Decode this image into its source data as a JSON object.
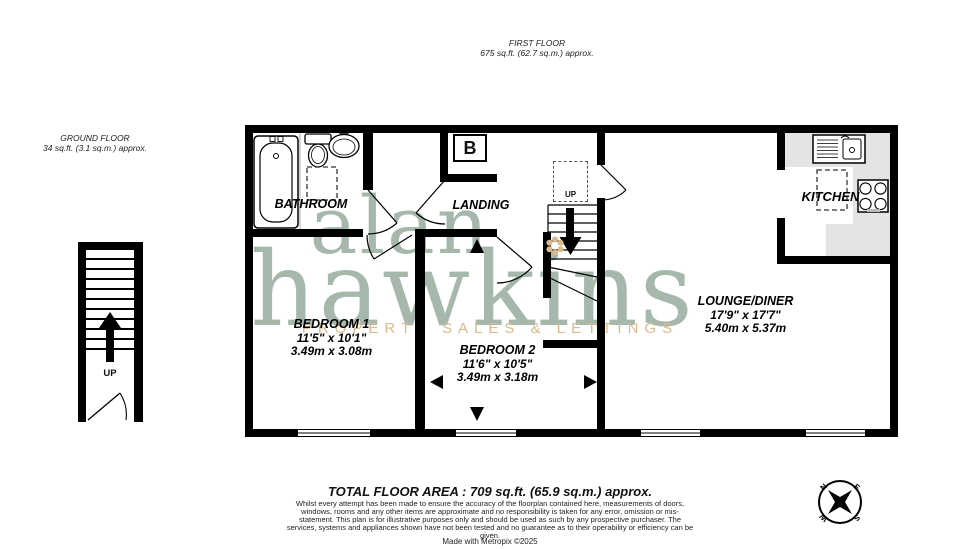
{
  "header": {
    "floor_title": "FIRST FLOOR",
    "floor_area": "675 sq.ft. (62.7 sq.m.) approx."
  },
  "ground_floor": {
    "title": "GROUND FLOOR",
    "area": "34 sq.ft. (3.1 sq.m.) approx.",
    "stairs_label": "UP"
  },
  "watermark": {
    "line1": "alan",
    "line2": "hawkins",
    "tagline": "PROPERTY SALES & LETTINGS",
    "colors": {
      "text": "#a6b7ac",
      "accent": "#d9ba8c"
    }
  },
  "rooms": {
    "bathroom": {
      "name": "BATHROOM"
    },
    "landing": {
      "name": "LANDING",
      "loft_label": "UP",
      "boiler_label": "B"
    },
    "kitchen": {
      "name": "KITCHEN"
    },
    "bedroom1": {
      "name": "BEDROOM 1",
      "imperial": "11'5\" x 10'1\"",
      "metric": "3.49m x 3.08m"
    },
    "bedroom2": {
      "name": "BEDROOM 2",
      "imperial": "11'6\" x 10'5\"",
      "metric": "3.49m x 3.18m"
    },
    "lounge": {
      "name": "LOUNGE/DINER",
      "imperial": "17'9\" x 17'7\"",
      "metric": "5.40m x 5.37m"
    }
  },
  "footer": {
    "total_area": "TOTAL FLOOR AREA : 709 sq.ft. (65.9 sq.m.) approx.",
    "disclaimer": "Whilst every attempt has been made to ensure the accuracy of the floorplan contained here, measurements of doors, windows, rooms and any other items are approximate and no responsibility is taken for any error, omission or mis-statement. This plan is for illustrative purposes only and should be used as such by any prospective purchaser. The services, systems and appliances shown have not been tested and no guarantee as to their operability or efficiency can be given.",
    "credit": "Made with Metropix ©2025"
  },
  "compass": {
    "n": "N",
    "e": "E",
    "s": "S",
    "w": "W"
  }
}
